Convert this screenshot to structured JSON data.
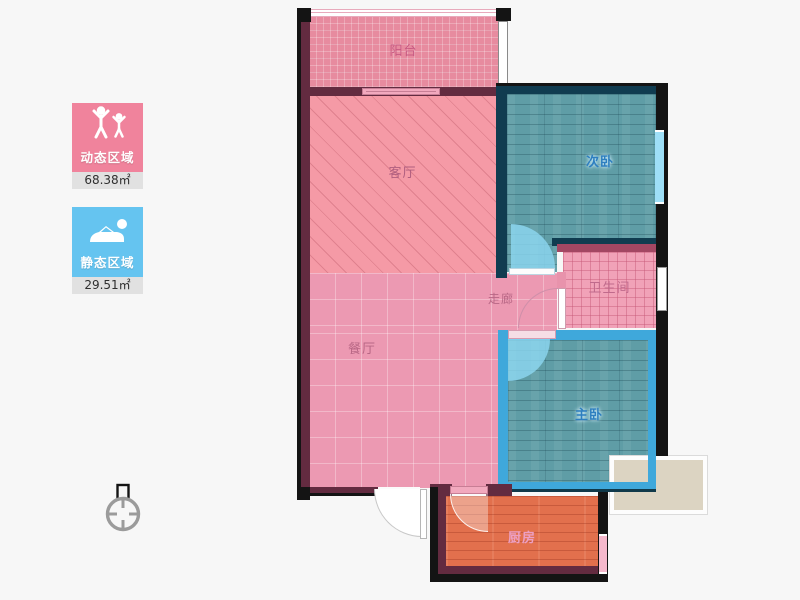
{
  "legend": {
    "dynamic": {
      "label": "动态区域",
      "area": "68.38㎡"
    },
    "static": {
      "label": "静态区域",
      "area": "29.51㎡"
    }
  },
  "rooms": {
    "balcony": "阳台",
    "living": "客厅",
    "bedroom2": "次卧",
    "bathroom": "卫生间",
    "corridor": "走廊",
    "dining": "餐厅",
    "master": "主卧",
    "kitchen": "厨房"
  },
  "colors": {
    "dynamic_card": "#F0839C",
    "static_card": "#65C4F0",
    "area_strip": "#E1E1E1",
    "dynamic_zone_floor": "#EC99B2",
    "static_zone_floor": "#5F9DA6",
    "kitchen_floor": "#E2704D",
    "wall_maroon": "#632B40",
    "wall_navy": "#103C50",
    "wall_black": "#141414",
    "wall_lightblue": "#3FA8DB",
    "room_label_pink": "#B86785",
    "room_label_blue": "#2E7FC0"
  }
}
